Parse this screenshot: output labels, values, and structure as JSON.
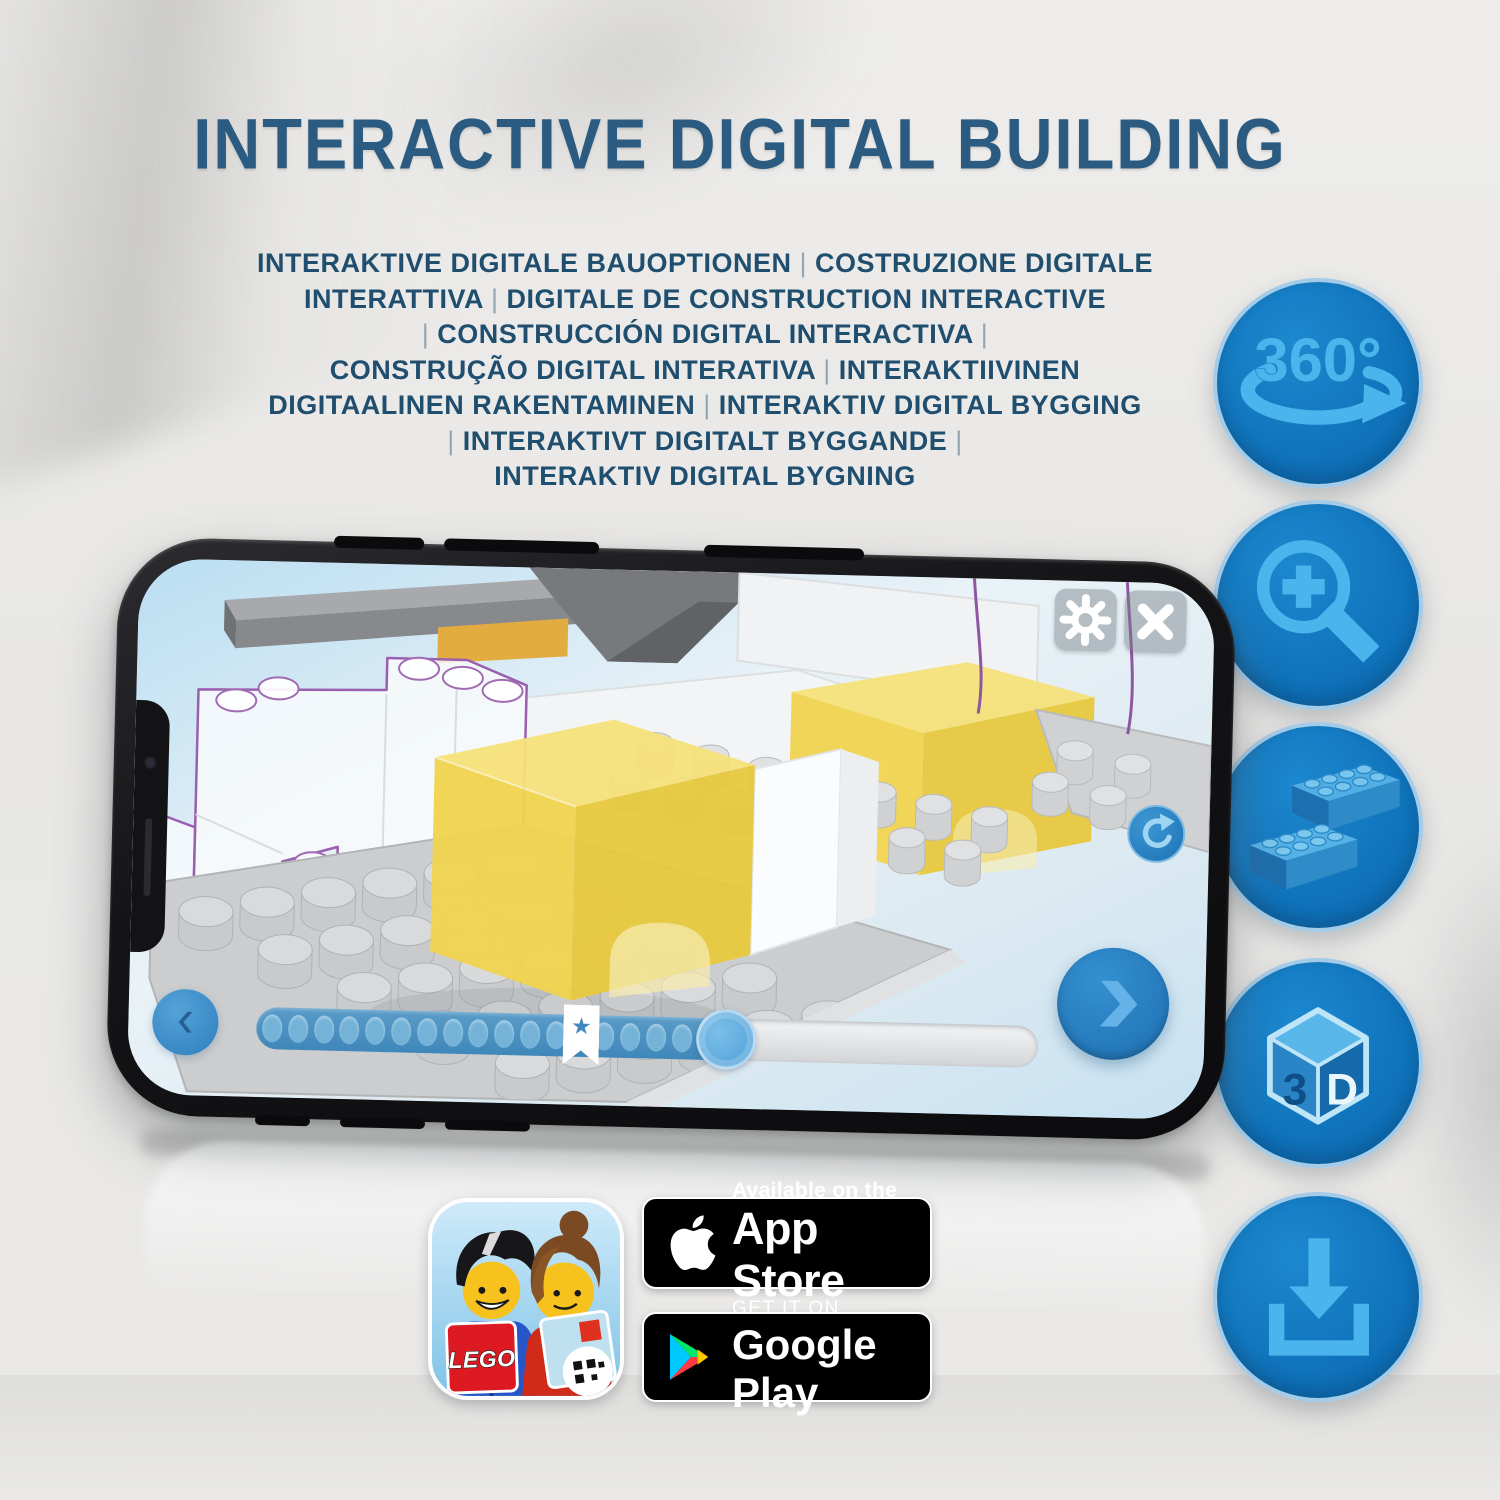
{
  "header": {
    "title": "INTERACTIVE DIGITAL BUILDING"
  },
  "subtitle": {
    "lines": [
      "INTERAKTIVE DIGITALE BAUOPTIONEN | COSTRUZIONE DIGITALE",
      "INTERATTIVA | DIGITALE DE CONSTRUCTION INTERACTIVE",
      "| CONSTRUCCIÓN DIGITAL INTERACTIVA |",
      "CONSTRUÇÃO DIGITAL INTERATIVA | INTERAKTIIVINEN",
      "DIGITAALINEN RAKENTAMINEN | INTERAKTIV DIGITAL BYGGING",
      "| INTERAKTIVT DIGITALT BYGGANDE |",
      "INTERAKTIV DIGITAL BYGNING"
    ]
  },
  "features": {
    "items": [
      {
        "name": "360-rotation",
        "label": "360°"
      },
      {
        "name": "zoom-in"
      },
      {
        "name": "interlocking-bricks"
      },
      {
        "name": "3d-view",
        "cube_left": "3",
        "cube_right": "D"
      },
      {
        "name": "download"
      }
    ]
  },
  "phone": {
    "app": {
      "progress": {
        "dots_before_bookmark": 12,
        "dots_after_bookmark": 4,
        "bookmark_star": "★"
      },
      "controls": [
        "settings",
        "close",
        "rotate",
        "previous",
        "next"
      ]
    }
  },
  "store": {
    "app_store": {
      "line1": "Available on the",
      "line2": "App Store"
    },
    "google_play": {
      "line1": "GET IT ON",
      "line2": "Google Play"
    }
  },
  "app_icon": {
    "logo_text": "LEGO"
  },
  "colors": {
    "background": "#e8e7e5",
    "heading": "#2b5b80",
    "subtitle": "#204e6f",
    "feature_circle": "#0e70b8",
    "feature_glyph": "#4ab4ec",
    "ui_blue": "#2b80c4",
    "brick_yellow": "#f1d44f",
    "outline_purple": "#9a5fae"
  }
}
